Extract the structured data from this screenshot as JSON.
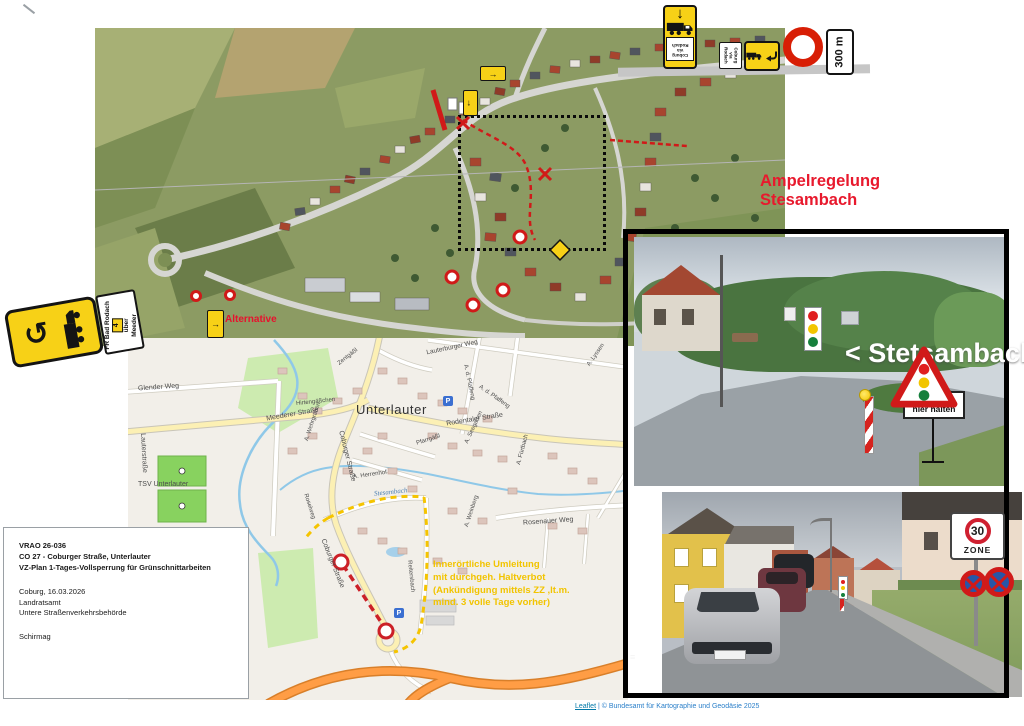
{
  "doc_box": {
    "ref": "VRAO 26-036",
    "subject1": "CO 27 - Coburger Straße, Unterlauter",
    "subject2": "VZ-Plan 1-Tages-Vollsperrung für Grünschnittarbeiten",
    "place_date": "Coburg, 16.03.2026",
    "authority1": "Landratsamt",
    "authority2": "Untere Straßenverkehrsbehörde",
    "signer": "Schirmag"
  },
  "overlays": {
    "ampel_line1": "Ampelregelung",
    "ampel_line2": "Stesambach",
    "alternative": "Alternative",
    "detour_note": [
      "Innerörtliche Umleitung",
      "mit durchgeh. Haltverbot",
      "(Ankündigung mittels ZZ ,lt.m.",
      "mind. 3 volle Tage vorher)"
    ],
    "stetsambach_photo": "< Stetsambach"
  },
  "signs": {
    "sign_300m": "300 m",
    "zone30_number": "30",
    "zone30_word": "ZONE",
    "bei_rot_line1": "bei Rot",
    "bei_rot_line2": "hier halten",
    "left_detour_lines": [
      "Meeder",
      "über",
      "4",
      "FR Bad Rodach"
    ],
    "mini_sign_a": [
      "Coburg",
      "via",
      "Rodach"
    ],
    "mini_sign_b": [
      "Coburg",
      "via",
      "Rodach"
    ],
    "parking": "P"
  },
  "icons": {
    "down_arrow": "↓",
    "right_arrow": "→",
    "uturn_arrow": "↺",
    "layers": "≡"
  },
  "map_labels": {
    "glender_weg": "Glender Weg",
    "lauterstrasse": "Lauterstraße",
    "tsv_unterlauter": "TSV Unterlauter",
    "hirtengaesschen": "Hirtengäßchen",
    "meederer_strasse": "Meederer Straße",
    "unterlauter": "Unterlauter",
    "zentgaessl": "Zentgäßl",
    "lauterburger_weg": "Lauterburger Weg",
    "ad_pfaffeng_1": "A. d. Pfaffeng",
    "ad_pfaffeng_2": "A. d. Pfaffeng",
    "rodentaler_strasse": "Rodentaler Straße",
    "a_lyssen": "A. Lyssen",
    "coburger_strasse_1": "Coburger Straße",
    "coburger_strasse_2": "Coburger Straße",
    "pfarrgaessl": "Pfarrgäßl",
    "a_seegarten": "A. Seegarten",
    "a_wehrgraben": "A. Wehrgraben",
    "a_herrenhof": "A. Herrenhof",
    "stesambach": "Stesambach",
    "roselweg": "Roselweg",
    "rosenauer_weg": "Rosenauer Weg",
    "a_weinberg": "A. Weinberg",
    "a_fuertbach": "A. Fürtbach",
    "reitersbach": "Reitersbach"
  },
  "attribution": {
    "leaflet": "Leaflet",
    "rest": " | © Bundesamt für Kartographie und Geodäsie 2025"
  },
  "colors": {
    "closure_red": "#cc2027",
    "detour_yellow": "#f5c400",
    "sign_yellow": "#f7d117",
    "annotation_red": "#e8112d"
  }
}
